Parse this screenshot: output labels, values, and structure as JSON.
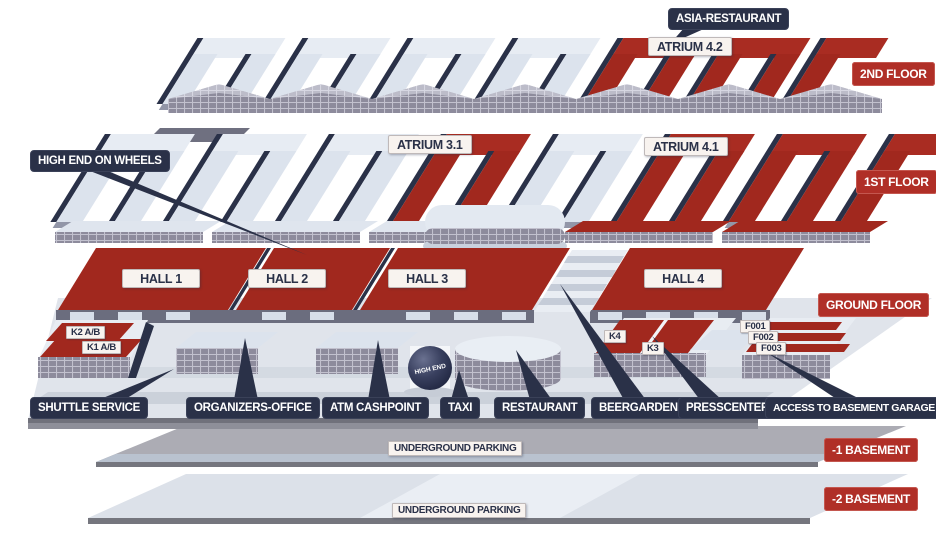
{
  "floor_labels": {
    "second": "2ND FLOOR",
    "first": "1ST FLOOR",
    "ground": "GROUND FLOOR",
    "basement1": "-1 BASEMENT",
    "basement2": "-2 BASEMENT"
  },
  "callouts": {
    "asia_restaurant": "ASIA-RESTAURANT",
    "high_end_on_wheels": "HIGH END ON WHEELS"
  },
  "atriums": {
    "a42": "ATRIUM 4.2",
    "a31": "ATRIUM 3.1",
    "a41": "ATRIUM 4.1"
  },
  "halls": [
    {
      "label": "HALL 1"
    },
    {
      "label": "HALL 2"
    },
    {
      "label": "HALL 3"
    },
    {
      "label": "HALL 4"
    }
  ],
  "entrances": {
    "k2ab": "K2 A/B",
    "k1ab": "K1 A/B",
    "k4": "K4",
    "k3": "K3",
    "f001": "F001",
    "f002": "F002",
    "f003": "F003"
  },
  "facilities": [
    "SHUTTLE SERVICE",
    "ORGANIZERS-OFFICE",
    "ATM CASHPOINT",
    "TAXI",
    "RESTAURANT",
    "BEERGARDEN",
    "PRESSCENTER",
    "ACCESS TO BASEMENT GARAGE"
  ],
  "underground": {
    "level1": "UNDERGROUND PARKING",
    "level2": "UNDERGROUND PARKING"
  },
  "sphere_label": "HIGH END",
  "colors": {
    "roof_red": "#A1281E",
    "badge_red": "#B02F27",
    "navy": "#2A3148",
    "surface_light": "#E2E8F0"
  }
}
